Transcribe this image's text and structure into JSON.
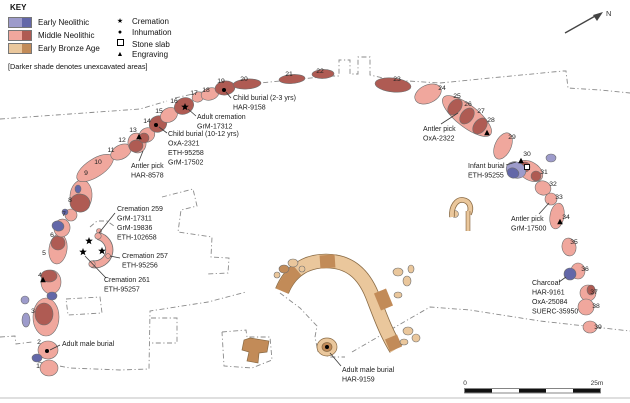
{
  "key": {
    "title": "KEY",
    "periods": [
      {
        "label": "Early Neolithic",
        "light": "#9D9BCB",
        "dark": "#6367A8"
      },
      {
        "label": "Middle Neolithic",
        "light": "#F0A79D",
        "dark": "#AF5B53"
      },
      {
        "label": "Early Bronze Age",
        "light": "#EAC79C",
        "dark": "#C28B58"
      }
    ],
    "symbols": [
      {
        "label": "Cremation",
        "marker": "cremation"
      },
      {
        "label": "Inhumation",
        "marker": "inhumation"
      },
      {
        "label": "Stone slab",
        "marker": "slab"
      },
      {
        "label": "Engraving",
        "marker": "engraving"
      }
    ],
    "note": "[Darker shade denotes unexcavated areas]"
  },
  "map": {
    "palette": {
      "mn-l": "#F0A79D",
      "mn-d": "#AF5B53",
      "en-l": "#9D9BCB",
      "en-d": "#6367A8",
      "eb-l": "#EAC79C",
      "eb-d": "#C28B58",
      "outline": "#6e6e6e",
      "band-edge": "#8a6b45",
      "dash": "#8a8a8a",
      "leader": "#3a3a3a",
      "text": "#1c1c1c"
    },
    "stones": [
      [
        49,
        368,
        9,
        8,
        0,
        "mn-l"
      ],
      [
        48,
        350,
        10,
        9,
        0,
        "mn-l"
      ],
      [
        46,
        317,
        13,
        19,
        0,
        "mn-l"
      ],
      [
        44,
        314,
        9,
        11,
        0,
        "mn-d"
      ],
      [
        51,
        282,
        10,
        12,
        0,
        "mn-l"
      ],
      [
        49,
        276,
        8,
        6,
        0,
        "mn-d"
      ],
      [
        58,
        249,
        9,
        15,
        8,
        "mn-l"
      ],
      [
        58,
        243,
        7,
        7,
        0,
        "mn-d"
      ],
      [
        62,
        228,
        8,
        9,
        12,
        "mn-l"
      ],
      [
        71,
        215,
        6,
        6,
        0,
        "mn-l"
      ],
      [
        81,
        196,
        11,
        16,
        5,
        "mn-l"
      ],
      [
        80,
        203,
        10,
        9,
        5,
        "mn-d"
      ],
      [
        95,
        168,
        21,
        9,
        -33,
        "mn-l"
      ],
      [
        121,
        152,
        11,
        7,
        -28,
        "mn-l"
      ],
      [
        137,
        143,
        9,
        10,
        -15,
        "mn-l"
      ],
      [
        136,
        146,
        7,
        6,
        -15,
        "mn-d"
      ],
      [
        147,
        135,
        8,
        7,
        -30,
        "mn-l"
      ],
      [
        144,
        138,
        5,
        5,
        0,
        "mn-d"
      ],
      [
        158,
        124,
        9,
        8,
        -30,
        "mn-d"
      ],
      [
        169,
        115,
        9,
        7,
        -30,
        "mn-l"
      ],
      [
        184,
        106,
        10,
        8,
        -25,
        "mn-d"
      ],
      [
        198,
        97,
        6,
        5,
        -20,
        "mn-l"
      ],
      [
        210,
        94,
        9,
        6,
        -15,
        "mn-l"
      ],
      [
        225,
        88,
        10,
        7,
        -8,
        "mn-d"
      ],
      [
        247,
        84,
        14,
        5,
        -4,
        "mn-d"
      ],
      [
        292,
        79,
        13,
        4.5,
        -4,
        "mn-d"
      ],
      [
        323,
        74,
        11,
        4.5,
        -2,
        "mn-d"
      ],
      [
        393,
        85,
        18,
        7,
        6,
        "mn-d"
      ],
      [
        428,
        94,
        14,
        9,
        -25,
        "mn-l"
      ],
      [
        467,
        116,
        30,
        11,
        38,
        "mn-l"
      ],
      [
        455,
        107,
        6,
        9,
        38,
        "mn-d"
      ],
      [
        467,
        116,
        6,
        9,
        38,
        "mn-d"
      ],
      [
        480,
        126,
        6,
        9,
        38,
        "mn-d"
      ],
      [
        503,
        146,
        8,
        14,
        25,
        "mn-l"
      ],
      [
        530,
        171,
        14,
        9,
        32,
        "mn-l"
      ],
      [
        525,
        167,
        5,
        5,
        32,
        "mn-d"
      ],
      [
        536,
        176,
        5,
        5,
        32,
        "mn-d"
      ],
      [
        543,
        188,
        8,
        7,
        20,
        "mn-l"
      ],
      [
        551,
        199,
        6,
        6,
        0,
        "mn-l"
      ],
      [
        557,
        216,
        7,
        13,
        10,
        "mn-l"
      ],
      [
        569,
        247,
        7,
        9,
        -10,
        "mn-l"
      ],
      [
        578,
        271,
        7,
        8,
        0,
        "mn-l"
      ],
      [
        588,
        293,
        8,
        8,
        0,
        "mn-l"
      ],
      [
        591,
        290,
        4,
        5,
        0,
        "mn-d"
      ],
      [
        586,
        307,
        8,
        8,
        0,
        "mn-l"
      ],
      [
        590,
        327,
        7,
        6,
        0,
        "mn-l"
      ],
      [
        99,
        231,
        2.5,
        2.5,
        0,
        "mn-l"
      ],
      [
        37,
        358,
        5,
        4,
        0,
        "en-d"
      ],
      [
        52,
        296,
        5,
        4,
        0,
        "en-d"
      ],
      [
        25,
        300,
        4,
        4,
        0,
        "en-l"
      ],
      [
        26,
        320,
        4,
        7,
        0,
        "en-l"
      ],
      [
        58,
        226,
        6,
        5,
        15,
        "en-d"
      ],
      [
        65,
        212,
        3,
        3,
        0,
        "en-d"
      ],
      [
        78,
        189,
        3,
        4,
        0,
        "en-d"
      ],
      [
        516,
        170,
        10,
        8,
        20,
        "en-l"
      ],
      [
        513,
        173,
        6,
        5,
        20,
        "en-d"
      ],
      [
        551,
        158,
        5,
        4,
        0,
        "en-l"
      ],
      [
        570,
        274,
        6,
        6,
        0,
        "en-d"
      ],
      [
        284,
        269,
        5,
        4,
        0,
        "eb-d"
      ],
      [
        293,
        263,
        5,
        4,
        0,
        "eb-l"
      ],
      [
        302,
        269,
        3,
        3,
        0,
        "eb-l"
      ],
      [
        277,
        275,
        3,
        3,
        0,
        "eb-l"
      ],
      [
        398,
        272,
        5,
        4,
        0,
        "eb-l"
      ],
      [
        407,
        281,
        4,
        5,
        0,
        "eb-l"
      ],
      [
        411,
        269,
        3,
        4,
        0,
        "eb-l"
      ],
      [
        398,
        295,
        4,
        3,
        0,
        "eb-l"
      ],
      [
        408,
        331,
        5,
        4,
        0,
        "eb-l"
      ],
      [
        416,
        338,
        4,
        4,
        0,
        "eb-l"
      ],
      [
        404,
        342,
        4,
        3,
        0,
        "eb-l"
      ],
      [
        455,
        214,
        3.5,
        3.5,
        0,
        "eb-l"
      ]
    ],
    "band": {
      "path": "M 282 291 C 290 271 306 261 326 261 C 349 261 363 273 372 295 C 378 310 385 331 396 349",
      "dark_segments": [
        "M 282 291 C 286 282 291 275 297 270",
        "M 320 262 L 335 261",
        "M 380 291 L 387 308",
        "M 391 337 L 396 349"
      ]
    },
    "ring": {
      "arc": "M 98 236 A 14 14 0 1 1 92 264",
      "terminals": [
        [
          98,
          236
        ],
        [
          92,
          264
        ]
      ],
      "dot": [
        108,
        256
      ]
    },
    "shapes": [
      {
        "t": "path",
        "d": "M 452 217 C 451 206 457 199 463 200 C 470 201 472 208 469 214",
        "s": "band-edge",
        "w": 5.6
      },
      {
        "t": "path",
        "d": "M 452 217 C 451 206 457 199 463 200 C 470 201 472 208 469 214",
        "s": "eb-l",
        "w": 4
      },
      {
        "t": "path",
        "d": "M 468 211 L 468 231",
        "s": "band-edge",
        "w": 4.6
      },
      {
        "t": "path",
        "d": "M 468 211 L 468 231",
        "s": "eb-l",
        "w": 3.2
      },
      {
        "t": "polygon",
        "p": "250,338 269,341 267,352 259,353 258,363 247,361 249,352 242,350 244,340",
        "f": "eb-d"
      },
      {
        "t": "ellipse",
        "cx": 327,
        "cy": 347,
        "rx": 10,
        "ry": 9,
        "f": "eb-l"
      },
      {
        "t": "ellipse",
        "cx": 327,
        "cy": 347,
        "rx": 5,
        "ry": 4.5,
        "f": "eb-d"
      },
      {
        "t": "path",
        "d": "M 0 398 L 630 398",
        "s": "#cccccc",
        "w": 1.2
      }
    ],
    "markers": [
      {
        "m": "engraving",
        "x": 43,
        "y": 280
      },
      {
        "m": "engraving",
        "x": 139,
        "y": 137
      },
      {
        "m": "engraving",
        "x": 487,
        "y": 133
      },
      {
        "m": "engraving",
        "x": 521,
        "y": 161
      },
      {
        "m": "engraving",
        "x": 560,
        "y": 222
      },
      {
        "m": "cremation",
        "x": 185,
        "y": 107
      },
      {
        "m": "cremation",
        "x": 89,
        "y": 241
      },
      {
        "m": "cremation",
        "x": 83,
        "y": 252
      },
      {
        "m": "cremation",
        "x": 102,
        "y": 251
      },
      {
        "m": "inhumation",
        "x": 47,
        "y": 351
      },
      {
        "m": "inhumation",
        "x": 156,
        "y": 125
      },
      {
        "m": "inhumation",
        "x": 224,
        "y": 90
      },
      {
        "m": "inhumation",
        "x": 327,
        "y": 347
      },
      {
        "m": "slab",
        "x": 527,
        "y": 167
      }
    ],
    "numbers": [
      [
        1,
        38,
        366
      ],
      [
        2,
        39,
        342
      ],
      [
        3,
        33,
        311
      ],
      [
        4,
        40,
        275
      ],
      [
        5,
        44,
        253
      ],
      [
        6,
        52,
        235
      ],
      [
        7,
        64,
        214
      ],
      [
        8,
        70,
        200
      ],
      [
        9,
        86,
        173
      ],
      [
        10,
        98,
        162
      ],
      [
        11,
        111,
        150
      ],
      [
        12,
        122,
        140
      ],
      [
        13,
        133,
        130
      ],
      [
        14,
        147,
        121
      ],
      [
        15,
        159,
        111
      ],
      [
        16,
        174,
        101
      ],
      [
        17,
        194,
        93
      ],
      [
        18,
        206,
        90
      ],
      [
        19,
        221,
        81
      ],
      [
        20,
        244,
        79
      ],
      [
        21,
        289,
        74
      ],
      [
        22,
        320,
        71
      ],
      [
        23,
        397,
        79
      ],
      [
        24,
        442,
        88
      ],
      [
        25,
        457,
        96
      ],
      [
        26,
        468,
        104
      ],
      [
        27,
        481,
        111
      ],
      [
        28,
        491,
        120
      ],
      [
        29,
        512,
        137
      ],
      [
        30,
        527,
        154
      ],
      [
        31,
        544,
        172
      ],
      [
        32,
        553,
        184
      ],
      [
        33,
        559,
        197
      ],
      [
        34,
        566,
        217
      ],
      [
        35,
        574,
        242
      ],
      [
        36,
        585,
        269
      ],
      [
        37,
        594,
        292
      ],
      [
        38,
        596,
        306
      ],
      [
        39,
        598,
        327
      ]
    ],
    "annotations": [
      {
        "lines": [
          "Child burial (2-3 yrs)",
          "HAR-9158"
        ],
        "x": 233,
        "y": 100,
        "leader": [
          231,
          98,
          226,
          92
        ]
      },
      {
        "lines": [
          "Adult cremation",
          "GrM-17312"
        ],
        "x": 197,
        "y": 119,
        "leader": [
          196,
          116,
          188,
          109
        ]
      },
      {
        "lines": [
          "Child burial (10-12 yrs)",
          "OxA-2321",
          "ETH-95258",
          "GrM-17502"
        ],
        "x": 168,
        "y": 136,
        "leader": [
          167,
          133,
          159,
          127
        ]
      },
      {
        "lines": [
          "Antler pick",
          "HAR-8578"
        ],
        "x": 131,
        "y": 168,
        "leader": [
          139,
          161,
          143,
          151
        ]
      },
      {
        "lines": [
          "Cremation 259",
          "GrM-17311",
          "GrM-19836",
          "ETH-102658"
        ],
        "x": 117,
        "y": 211,
        "leader": [
          115,
          213,
          99,
          233
        ]
      },
      {
        "lines": [
          "Cremation 257",
          "ETH-95256"
        ],
        "x": 122,
        "y": 258,
        "leader": [
          120,
          258,
          110,
          256
        ]
      },
      {
        "lines": [
          "Cremation 261",
          "ETH-95257"
        ],
        "x": 104,
        "y": 282,
        "leader": [
          106,
          278,
          85,
          256
        ]
      },
      {
        "lines": [
          "Adult male burial"
        ],
        "x": 62,
        "y": 346,
        "leader": [
          60,
          345,
          50,
          350
        ]
      },
      {
        "lines": [
          "Antler pick",
          "OxA-2322"
        ],
        "x": 423,
        "y": 131,
        "leader": [
          441,
          124,
          458,
          113
        ]
      },
      {
        "lines": [
          "Infant burial",
          "ETH-95255"
        ],
        "x": 468,
        "y": 168,
        "leader": [
          506,
          165,
          516,
          162
        ]
      },
      {
        "lines": [
          "Antler pick",
          "GrM-17500"
        ],
        "x": 511,
        "y": 221,
        "leader": [
          539,
          214,
          549,
          203
        ]
      },
      {
        "lines": [
          "Charcoal",
          "HAR-9161",
          "OxA-25084",
          "SUERC-35950"
        ],
        "x": 532,
        "y": 285,
        "leader": [
          559,
          282,
          566,
          277
        ]
      },
      {
        "lines": [
          "Adult male burial",
          "HAR-9159"
        ],
        "x": 342,
        "y": 372,
        "leader": [
          341,
          366,
          330,
          353
        ]
      }
    ],
    "dashes": [
      [
        [
          0,
          119
        ],
        [
          70,
          114
        ],
        [
          140,
          109
        ],
        [
          167,
          101
        ]
      ],
      [
        [
          175,
          98
        ],
        [
          210,
          90
        ],
        [
          250,
          84
        ],
        [
          300,
          79
        ],
        [
          333,
          76
        ],
        [
          339,
          76
        ],
        [
          339,
          60
        ],
        [
          350,
          60
        ],
        [
          350,
          74
        ],
        [
          358,
          74
        ],
        [
          358,
          57
        ],
        [
          370,
          57
        ],
        [
          370,
          75
        ],
        [
          392,
          80
        ],
        [
          440,
          83
        ]
      ],
      [
        [
          440,
          83
        ],
        [
          480,
          79
        ],
        [
          563,
          71
        ],
        [
          566,
          71
        ],
        [
          568,
          88
        ],
        [
          600,
          90
        ],
        [
          630,
          93
        ]
      ],
      [
        [
          162,
          197
        ],
        [
          193,
          189
        ],
        [
          197,
          206
        ],
        [
          181,
          210
        ],
        [
          178,
          232
        ],
        [
          212,
          237
        ],
        [
          211,
          257
        ],
        [
          229,
          258
        ],
        [
          228,
          273
        ],
        [
          207,
          274
        ]
      ],
      [
        [
          66,
          299
        ],
        [
          100,
          297
        ],
        [
          102,
          313
        ],
        [
          68,
          315
        ],
        [
          66,
          299
        ]
      ],
      [
        [
          0,
          337
        ],
        [
          15,
          336
        ],
        [
          16,
          344
        ],
        [
          32,
          342
        ]
      ],
      [
        [
          38,
          362
        ],
        [
          70,
          368
        ],
        [
          120,
          370
        ],
        [
          149,
          369
        ],
        [
          150,
          311
        ],
        [
          208,
          302
        ],
        [
          246,
          292
        ]
      ],
      [
        [
          151,
          318
        ],
        [
          177,
          318
        ],
        [
          177,
          343
        ],
        [
          151,
          343
        ]
      ],
      [
        [
          222,
          332
        ],
        [
          246,
          330
        ],
        [
          247,
          337
        ],
        [
          270,
          337
        ],
        [
          272,
          360
        ],
        [
          252,
          368
        ],
        [
          224,
          366
        ],
        [
          222,
          332
        ]
      ],
      [
        [
          280,
          293
        ],
        [
          300,
          308
        ],
        [
          317,
          326
        ],
        [
          315,
          337
        ],
        [
          318,
          352
        ],
        [
          330,
          357
        ],
        [
          345,
          357
        ]
      ],
      [
        [
          352,
          352
        ],
        [
          390,
          330
        ],
        [
          430,
          307
        ],
        [
          470,
          310
        ],
        [
          540,
          321
        ],
        [
          630,
          331
        ]
      ],
      [
        [
          90,
          227
        ],
        [
          97,
          221
        ],
        [
          107,
          221
        ],
        [
          114,
          226
        ]
      ]
    ],
    "north": {
      "label": "N",
      "line": [
        565,
        33,
        597,
        15
      ],
      "head": "603,12 593,15 597,21",
      "lx": 606,
      "ly": 16
    },
    "scalebar": {
      "x": 465,
      "y": 389,
      "w": 135,
      "h": 3.5,
      "segments": 5,
      "start": "0",
      "end": "25m"
    }
  }
}
